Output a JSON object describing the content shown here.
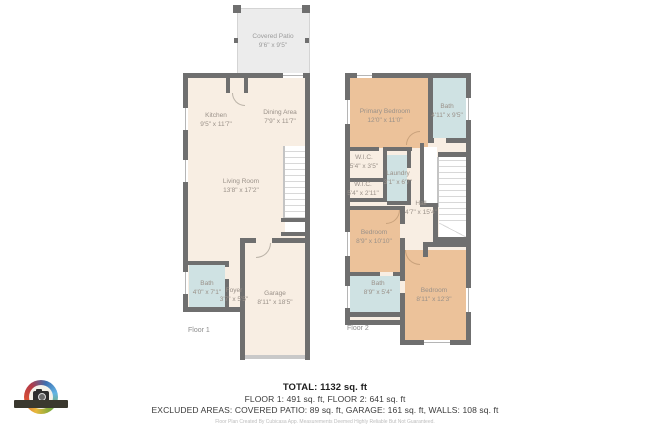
{
  "floor1": {
    "label": "Floor 1",
    "rooms": [
      {
        "name": "Covered Patio",
        "dims": "9'6\" x 9'5\""
      },
      {
        "name": "Kitchen",
        "dims": "9'5\" x 11'7\""
      },
      {
        "name": "Dining Area",
        "dims": "7'9\" x 11'7\""
      },
      {
        "name": "Living Room",
        "dims": "13'8\" x 17'2\""
      },
      {
        "name": "Bath",
        "dims": "4'0\" x 7'1\""
      },
      {
        "name": "Foyer",
        "dims": "3'7\" x 5'5\""
      },
      {
        "name": "Garage",
        "dims": "8'11\" x 18'5\""
      }
    ]
  },
  "floor2": {
    "label": "Floor 2",
    "rooms": [
      {
        "name": "Primary Bedroom",
        "dims": "12'0\" x 11'0\""
      },
      {
        "name": "Bath",
        "dims": "4'11\" x 9'5\""
      },
      {
        "name": "W.I.C.",
        "dims": "5'4\" x 3'5\""
      },
      {
        "name": "W.I.C.",
        "dims": "5'4\" x 2'11\""
      },
      {
        "name": "Laundry",
        "dims": "3'1\" x 6'7\""
      },
      {
        "name": "Hall",
        "dims": "4'7\" x 15'4\""
      },
      {
        "name": "Bedroom",
        "dims": "8'9\" x 10'10\""
      },
      {
        "name": "Bath",
        "dims": "8'9\" x 5'4\""
      },
      {
        "name": "Bedroom",
        "dims": "8'11\" x 12'3\""
      }
    ]
  },
  "summary": {
    "total": "TOTAL: 1132 sq. ft",
    "floors": "FLOOR 1: 491 sq. ft, FLOOR 2: 641 sq. ft",
    "excluded": "EXCLUDED AREAS: COVERED PATIO: 89 sq. ft, GARAGE: 161 sq. ft, WALLS: 108 sq. ft",
    "disclaimer": "Floor Plan Created By Cubicasa App. Measurements Deemed Highly Reliable But Not Guaranteed."
  },
  "colors": {
    "wall": "#6f6f6f",
    "floor": "#f8eee3",
    "bedroom": "#ecc29a",
    "wet_room": "#cfe2e3",
    "patio": "#ececec",
    "label_text": "#9a9189"
  }
}
